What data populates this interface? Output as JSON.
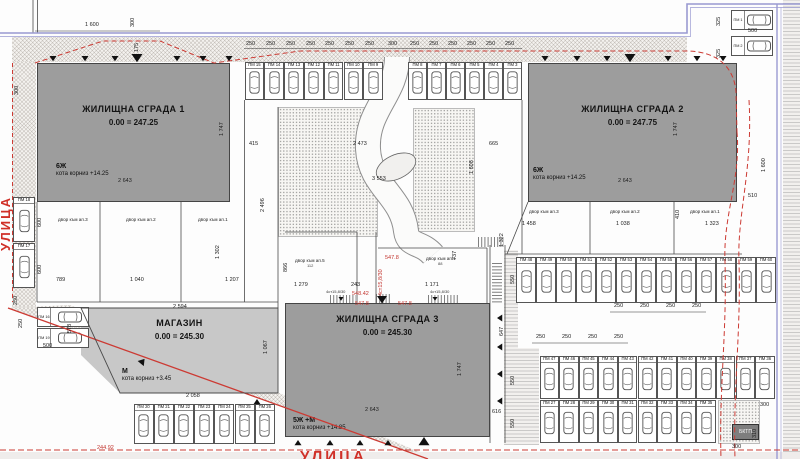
{
  "colors": {
    "building": "#9d9d9d",
    "shop": "#c8c8c8",
    "red_line": "#cc3a33",
    "boundary_blue": "#9a9ad2"
  },
  "streets": {
    "left": "УЛИЦА",
    "bottom": "УЛИЦА",
    "benchmark": "244.92"
  },
  "buildings": {
    "b1": {
      "title": "ЖИЛИЩНА СГРАДА 1",
      "level": "0.00 = 247.25",
      "floors": "6Ж",
      "cornice": "кота корниз  +14.25"
    },
    "b2": {
      "title": "ЖИЛИЩНА СГРАДА 2",
      "level": "0.00 = 247.75",
      "floors": "6Ж",
      "cornice": "кота корниз  +14.25"
    },
    "b3": {
      "title": "ЖИЛИЩНА СГРАДА 3",
      "level": "0.00 = 245.30",
      "floors": "5Ж +М",
      "cornice": "кота корниз  +14.85"
    },
    "shop": {
      "title": "МАГАЗИН",
      "level": "0.00 = 245.30",
      "floors": "М",
      "cornice": "кота корниз  +3.45"
    },
    "substation": "БКТП"
  },
  "yards": {
    "l3": "двор към ап.3",
    "l2": "двор към ап.2",
    "l1": "двор към ап.1",
    "m5": "двор към ап.5",
    "m5n": "112",
    "m1": "двор към ап.1",
    "m1n": "88",
    "r3": "двор към ап.3",
    "r2": "двор към ап.2",
    "r1": "двор към ап.1"
  },
  "red_marks": {
    "e1": "547.8",
    "e2": "548.42",
    "e3": "547.8",
    "e4": "547.8",
    "stairs_v": "4ст15,8/30"
  },
  "stair_labels": {
    "s1": "4ст15,8/30",
    "s2": "4ст15,8/30"
  },
  "dims": {
    "a1600": "1 600",
    "a300": "300",
    "a175": "175",
    "b300": "300",
    "c325a": "325",
    "c500": "500",
    "c325b": "325",
    "c510": "510",
    "c1600": "1 600",
    "m415": "415",
    "m2473": "2 473",
    "m665": "665",
    "m3553": "3 553",
    "m1608": "1 608",
    "m2496": "2 496",
    "h1747a": "1 747",
    "h1747b": "1 747",
    "h1747c": "1 747",
    "w2643a": "2 643",
    "w2643b": "2 643",
    "w2643c": "2 643",
    "y600a": "600",
    "y600b": "600",
    "y789": "789",
    "y1040": "1 040",
    "y1207": "1 207",
    "y1302": "1 302",
    "y866": "866",
    "s2594": "2 594",
    "s578": "578",
    "s500": "500",
    "s250a": "250",
    "s250b": "250",
    "s1067": "1 067",
    "s2058": "2 058",
    "q1279": "1 279",
    "q243": "243",
    "q1171": "1 171",
    "q737": "737",
    "r1458": "1 458",
    "r1038": "1 038",
    "r1323": "1 323",
    "r410": "410",
    "r1322": "1 322",
    "p550a": "550",
    "p647": "647",
    "p550b": "550",
    "p550c": "550",
    "p616": "616",
    "p300a": "300",
    "p310": "310",
    "p300b": "300"
  },
  "dim_rows": {
    "top": [
      "250",
      "250",
      "250",
      "250",
      "250",
      "250",
      "250",
      "300",
      "250",
      "250",
      "250",
      "250",
      "250",
      "250"
    ],
    "right_upper": [
      "250",
      "250",
      "250",
      "250"
    ],
    "right_lower": [
      "250",
      "250",
      "250",
      "250"
    ]
  },
  "parking": {
    "rows": [
      {
        "id": "topCorner",
        "labels": [
          "ПМ 1",
          "ПМ 2"
        ]
      },
      {
        "id": "topRight",
        "labels": [
          "ПМ 8",
          "ПМ 7",
          "ПМ 6",
          "ПМ 5",
          "ПМ 4",
          "ПМ 3"
        ]
      },
      {
        "id": "topLeft",
        "labels": [
          "ПМ 15",
          "ПМ 14",
          "ПМ 13",
          "ПМ 12",
          "ПМ 11",
          "ПМ 10",
          "ПМ 9"
        ]
      },
      {
        "id": "leftVert",
        "labels": [
          "ПМ 18",
          "ПМ 17"
        ]
      },
      {
        "id": "leftPair",
        "labels": [
          "ПМ 16",
          "ПМ 19"
        ]
      },
      {
        "id": "bottomCenter",
        "labels": [
          "ПМ 20",
          "ПМ 21",
          "ПМ 22",
          "ПМ 23",
          "ПМ 24",
          "ПМ 25",
          "ПМ 26"
        ]
      },
      {
        "id": "rightA",
        "labels": [
          "ПМ 48",
          "ПМ 49",
          "ПМ 50",
          "ПМ 51",
          "ПМ 52",
          "ПМ 53",
          "ПМ 54",
          "ПМ 55",
          "ПМ 56",
          "ПМ 57",
          "ПМ 58",
          "ПМ 59",
          "ПМ 60"
        ]
      },
      {
        "id": "rightB",
        "labels": [
          "ПМ 47",
          "ПМ 46",
          "ПМ 45",
          "ПМ 44",
          "ПМ 43",
          "ПМ 42",
          "ПМ 41",
          "ПМ 40",
          "ПМ 39",
          "ПМ 38",
          "ПМ 37",
          "ПМ 36"
        ]
      },
      {
        "id": "rightC",
        "labels": [
          "ПМ 27",
          "ПМ 28",
          "ПМ 29",
          "ПМ 30",
          "ПМ 31",
          "ПМ 32",
          "ПМ 33",
          "ПМ 34",
          "ПМ 35"
        ]
      }
    ]
  }
}
